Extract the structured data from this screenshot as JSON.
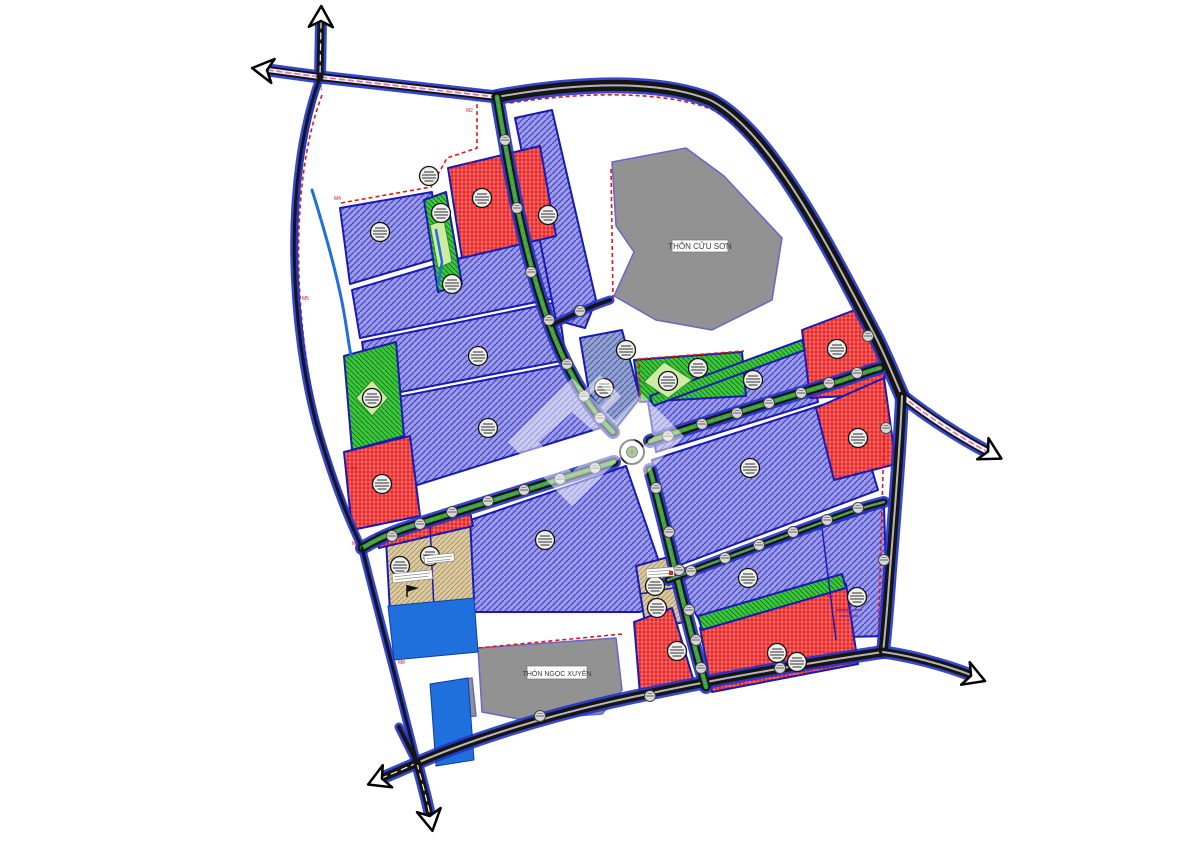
{
  "page": {
    "background": "#ffffff"
  },
  "labels": {
    "village_top": "THÔN CỬU SƠN",
    "village_bottom": "THÔN NGỌC XUYÊN"
  },
  "colors": {
    "parcel_purple": "#9a9ae8",
    "parcel_purple_hatch": "#3c3cc0",
    "parcel_red": "#e62525",
    "parcel_red_hatch": "#ffaaaa",
    "parcel_green": "#3ec43e",
    "parcel_green_hatch": "#0c7a0c",
    "parcel_tan": "#dbc9a0",
    "parcel_tan_hatch": "#a8905e",
    "parcel_bluegray": "#93a2cf",
    "parcel_bluegray_hatch": "#4c5ca8",
    "village_gray": "#929292",
    "village_stroke": "#6666cc",
    "parcel_stroke": "#1a1ab2",
    "water_blue": "#1f6fdd",
    "road_black": "#151515",
    "road_casing": "#2233cc",
    "median_green": "#2dad2d",
    "median_purple_dash": "#b070d0",
    "pink_stripe": "#d96fc0",
    "boundary_red": "#e81515",
    "light_green": "#cdeba1",
    "stamp_fill": "#eeeeec",
    "label_text": "#3a3a3a"
  },
  "map": {
    "width": 1200,
    "height": 848,
    "parcels": [
      {
        "name": "parcel-industrial",
        "type": "purple",
        "points": "340,208 432,192 438,258 350,284"
      },
      {
        "name": "parcel-industrial",
        "type": "purple",
        "points": "352,290 548,232 556,298 360,338"
      },
      {
        "name": "parcel-industrial",
        "type": "purple",
        "points": "362,342 558,302 566,360 370,398"
      },
      {
        "name": "parcel-industrial",
        "type": "purple",
        "points": "372,402 568,364 600,428 382,496"
      },
      {
        "name": "parcel-industrial",
        "type": "purple",
        "points": "465,522 626,466 670,594 640,612 470,612"
      },
      {
        "name": "parcel-industrial",
        "type": "purple",
        "points": "515,118 552,110 596,300 585,328 556,320"
      },
      {
        "name": "parcel-industrial",
        "type": "purple",
        "points": "648,402 806,344 818,402 656,452"
      },
      {
        "name": "parcel-industrial",
        "type": "purple",
        "points": "652,460 850,396 878,490 672,568"
      },
      {
        "name": "parcel-industrial",
        "type": "purple",
        "points": "676,578 884,506 888,636 710,640"
      },
      {
        "name": "parcel-residential",
        "type": "tan",
        "points": "386,540 470,518 474,600 390,612"
      },
      {
        "name": "parcel-residential",
        "type": "tan",
        "points": "636,566 672,556 684,622 646,630"
      },
      {
        "name": "parcel-service",
        "type": "red",
        "points": "448,168 540,146 556,236 462,258"
      },
      {
        "name": "parcel-service",
        "type": "red",
        "points": "344,452 410,436 420,516 352,530"
      },
      {
        "name": "parcel-service",
        "type": "red",
        "points": "376,534 470,512 473,526 379,548"
      },
      {
        "name": "parcel-service",
        "type": "red",
        "points": "802,330 860,308 888,356 882,394 810,398"
      },
      {
        "name": "parcel-service",
        "type": "red",
        "points": "816,408 884,378 896,464 834,480"
      },
      {
        "name": "parcel-service",
        "type": "red",
        "points": "700,628 846,584 858,664 712,692"
      },
      {
        "name": "parcel-service",
        "type": "red",
        "points": "634,622 672,608 694,682 640,694"
      },
      {
        "name": "parcel-park",
        "type": "green",
        "points": "424,200 446,192 462,284 438,292"
      },
      {
        "name": "parcel-park",
        "type": "green",
        "points": "344,356 396,342 404,436 352,450"
      },
      {
        "name": "parcel-park",
        "type": "green",
        "points": "634,360 742,352 746,396 640,402"
      },
      {
        "name": "parcel-park",
        "type": "green",
        "points": "650,396 802,340 805,350 653,406"
      },
      {
        "name": "parcel-park",
        "type": "green",
        "points": "698,616 842,574 846,588 702,630"
      },
      {
        "name": "parcel-utility",
        "type": "bluegray",
        "points": "580,338 622,330 640,398 616,428 592,410"
      },
      {
        "name": "village-area-top",
        "type": "gray",
        "points": "612,162 686,148 724,176 782,238 772,300 712,330 656,320 614,296 634,252 616,226"
      },
      {
        "name": "village-area-bottom",
        "type": "gray",
        "points": "478,648 616,638 622,690 602,714 524,720 482,712"
      },
      {
        "name": "village-area-bottom-annex",
        "type": "gray",
        "points": "432,684 472,678 476,716 436,720"
      }
    ],
    "details": {
      "lightgreen": [
        "430,225 444,220 452,262 438,268",
        "372,380 388,398 372,416 356,398",
        "664,362 692,380 668,398 644,382"
      ],
      "dividers": [
        "M 430,524 L 434,610",
        "M 640,594 L 684,586",
        "M 822,528 L 836,640"
      ],
      "micro_boxes": [
        {
          "x": 392,
          "y": 574,
          "w": 40,
          "h": 9,
          "rot": -6
        },
        {
          "x": 424,
          "y": 556,
          "w": 30,
          "h": 8,
          "rot": -6
        },
        {
          "x": 646,
          "y": 569,
          "w": 28,
          "h": 9,
          "rot": -4
        }
      ],
      "micro_lines": [
        {
          "x": 836,
          "y": 610,
          "w": 26
        },
        {
          "x": 840,
          "y": 616,
          "w": 18
        }
      ],
      "flag": {
        "x": 407,
        "y": 585
      },
      "red_dot": {
        "x": 671,
        "y": 573
      }
    },
    "water": {
      "lines": [
        {
          "d": "M 321,80 C 284,180 292,330 320,432 C 334,480 348,516 362,548",
          "w": 4
        },
        {
          "d": "M 312,190 C 322,222 334,262 342,302 C 346,322 348,340 351,356",
          "w": 3
        },
        {
          "d": "M 362,548 C 378,612 396,678 417,763",
          "w": 4
        },
        {
          "d": "M 436,230 L 442,262 L 438,285",
          "w": 2.5
        }
      ],
      "ponds": [
        "388,606 474,598 478,652 394,660",
        "430,684 468,678 474,760 436,766"
      ]
    },
    "roads": [
      {
        "name": "road-topleft-horizontal",
        "style": "pink",
        "w": 8,
        "d": "M 268,70 L 320,77 L 497,97"
      },
      {
        "name": "road-north-stub",
        "style": "plain",
        "w": 7,
        "d": "M 321,22 L 320,77"
      },
      {
        "name": "road-left-edge",
        "style": "thin",
        "w": 3,
        "d": "M 320,77 C 282,180 290,330 318,430 C 332,478 346,515 362,548"
      },
      {
        "name": "highway-top",
        "style": "hw",
        "w": 11,
        "d": "M 497,97 C 580,82 660,80 710,100 C 770,130 830,250 872,330 C 884,352 894,378 902,396"
      },
      {
        "name": "highway-east-exit",
        "style": "pink",
        "w": 9,
        "d": "M 902,396 C 930,418 958,436 988,452"
      },
      {
        "name": "highway-right",
        "style": "hw",
        "w": 9,
        "d": "M 902,396 C 900,450 894,520 890,570 C 887,612 885,635 883,652"
      },
      {
        "name": "road-bottom",
        "style": "hw",
        "w": 9,
        "d": "M 417,763 C 470,740 540,718 610,702 C 700,682 800,664 883,652"
      },
      {
        "name": "road-bottom-east-exit",
        "style": "hw",
        "w": 8,
        "d": "M 883,652 C 912,656 945,665 971,675"
      },
      {
        "name": "road-bottom-sw-exit",
        "style": "plain",
        "w": 8,
        "d": "M 417,763 L 382,778"
      },
      {
        "name": "road-bottom-south-stub",
        "style": "plain",
        "w": 7,
        "d": "M 417,763 C 424,790 428,804 430,816"
      },
      {
        "name": "road-bottom-nw-stub",
        "style": "thin",
        "w": 4,
        "d": "M 417,763 L 399,727"
      },
      {
        "name": "road-axis-north",
        "style": "green",
        "w": 9,
        "d": "M 497,97 C 508,160 520,240 548,320 C 562,360 585,405 613,432"
      },
      {
        "name": "road-axis-south",
        "style": "green",
        "w": 9,
        "d": "M 650,470 C 663,515 678,585 697,655 C 700,667 704,678 706,687"
      },
      {
        "name": "road-west-branch",
        "style": "green",
        "w": 9,
        "d": "M 614,462 C 550,482 470,508 415,525 C 395,531 377,539 362,548"
      },
      {
        "name": "road-east-branch",
        "style": "green",
        "w": 9,
        "d": "M 650,441 C 710,421 790,396 840,381 C 855,376 868,371 880,368"
      },
      {
        "name": "road-southeast-branch",
        "style": "green",
        "w": 7,
        "d": "M 668,580 C 720,560 790,534 845,514 C 858,509 872,505 884,502"
      },
      {
        "name": "road-village-stub",
        "style": "thin",
        "w": 4,
        "d": "M 552,325 C 572,315 592,306 610,300"
      },
      {
        "name": "road-canal-south",
        "style": "thin",
        "w": 3,
        "d": "M 362,548 C 378,612 396,678 417,763"
      }
    ],
    "roundabout": {
      "x": 632,
      "y": 452
    },
    "junctions": [
      [
        505,
        140
      ],
      [
        517,
        208
      ],
      [
        531,
        272
      ],
      [
        549,
        320
      ],
      [
        567,
        364
      ],
      [
        584,
        396
      ],
      [
        600,
        418
      ],
      [
        656,
        488
      ],
      [
        669,
        532
      ],
      [
        679,
        570
      ],
      [
        689,
        610
      ],
      [
        696,
        640
      ],
      [
        701,
        668
      ],
      [
        595,
        468
      ],
      [
        560,
        479
      ],
      [
        524,
        490
      ],
      [
        488,
        501
      ],
      [
        452,
        512
      ],
      [
        420,
        524
      ],
      [
        392,
        536
      ],
      [
        668,
        436
      ],
      [
        702,
        424
      ],
      [
        737,
        413
      ],
      [
        769,
        403
      ],
      [
        801,
        393
      ],
      [
        829,
        383
      ],
      [
        857,
        373
      ],
      [
        691,
        571
      ],
      [
        725,
        558
      ],
      [
        759,
        545
      ],
      [
        793,
        532
      ],
      [
        827,
        520
      ],
      [
        858,
        508
      ],
      [
        580,
        311
      ],
      [
        868,
        336
      ],
      [
        886,
        428
      ],
      [
        884,
        560
      ],
      [
        540,
        716
      ],
      [
        650,
        696
      ],
      [
        780,
        668
      ]
    ],
    "stamps": [
      [
        380,
        232
      ],
      [
        452,
        284
      ],
      [
        478,
        356
      ],
      [
        488,
        428
      ],
      [
        545,
        540
      ],
      [
        548,
        215
      ],
      [
        604,
        388
      ],
      [
        626,
        350
      ],
      [
        668,
        381
      ],
      [
        698,
        368
      ],
      [
        753,
        380
      ],
      [
        837,
        349
      ],
      [
        858,
        438
      ],
      [
        750,
        468
      ],
      [
        748,
        578
      ],
      [
        857,
        597
      ],
      [
        777,
        653
      ],
      [
        797,
        662
      ],
      [
        482,
        198
      ],
      [
        441,
        213
      ],
      [
        429,
        176
      ],
      [
        372,
        398
      ],
      [
        382,
        484
      ],
      [
        400,
        566
      ],
      [
        430,
        556
      ],
      [
        655,
        586
      ],
      [
        657,
        608
      ],
      [
        677,
        651
      ]
    ],
    "boundary": {
      "segments": [
        "M 322,95 C 288,185 294,330 321,432 C 335,480 349,516 363,548",
        "M 341,203 L 431,187 L 447,158 L 477,148 L 477,98",
        "M 510,103 C 590,91 668,91 716,111 C 772,147 834,261 874,345 L 884,370",
        "M 885,400 L 878,651",
        "M 877,653 C 800,665 748,675 707,686",
        "M 622,634 L 478,648",
        "M 640,403 L 639,359 L 744,351",
        "M 613,299 L 611,166",
        "M 363,549 C 378,612 396,678 414,758"
      ],
      "markers": [
        {
          "t": "M1",
          "x": 316,
          "y": 90
        },
        {
          "t": "M2",
          "x": 466,
          "y": 112
        },
        {
          "t": "M3",
          "x": 468,
          "y": 166
        },
        {
          "t": "M4",
          "x": 334,
          "y": 200
        },
        {
          "t": "M5",
          "x": 302,
          "y": 300
        },
        {
          "t": "M6",
          "x": 350,
          "y": 470
        },
        {
          "t": "M7",
          "x": 352,
          "y": 545
        },
        {
          "t": "M8",
          "x": 398,
          "y": 664
        }
      ]
    },
    "arrows": [
      {
        "x": 266,
        "y": 70,
        "rot": 188
      },
      {
        "x": 321,
        "y": 20,
        "rot": -89
      },
      {
        "x": 989,
        "y": 452,
        "rot": 28
      },
      {
        "x": 972,
        "y": 676,
        "rot": 21
      },
      {
        "x": 381,
        "y": 779,
        "rot": 157
      },
      {
        "x": 430,
        "y": 817,
        "rot": 80
      }
    ],
    "village_labels": [
      {
        "bind": "village_top",
        "name": "village-label-top",
        "x": 700,
        "y": 249,
        "bx": 672,
        "by": 240,
        "bw": 56,
        "bh": 12,
        "fs": 8
      },
      {
        "bind": "village_bottom",
        "name": "village-label-bottom",
        "x": 557,
        "y": 676,
        "bx": 527,
        "by": 666,
        "bw": 60,
        "bh": 13,
        "fs": 7
      }
    ],
    "watermark": {
      "opacity": 0.5,
      "color": "#ffffff",
      "rings": [
        {
          "outer": "M 572,378 L 508,442 L 572,506 L 636,442 Z",
          "inner": "M 572,412 L 538,442 L 572,472 L 606,442 Z"
        },
        {
          "outer": "M 642,394 L 600,436 L 642,478 L 684,436 Z",
          "inner": "M 642,424 L 630,436 L 642,448 L 654,436 Z"
        }
      ],
      "outline": {
        "d": "M 600,380 L 584,396 L 600,412 L 616,396 Z",
        "w": 7
      }
    }
  }
}
